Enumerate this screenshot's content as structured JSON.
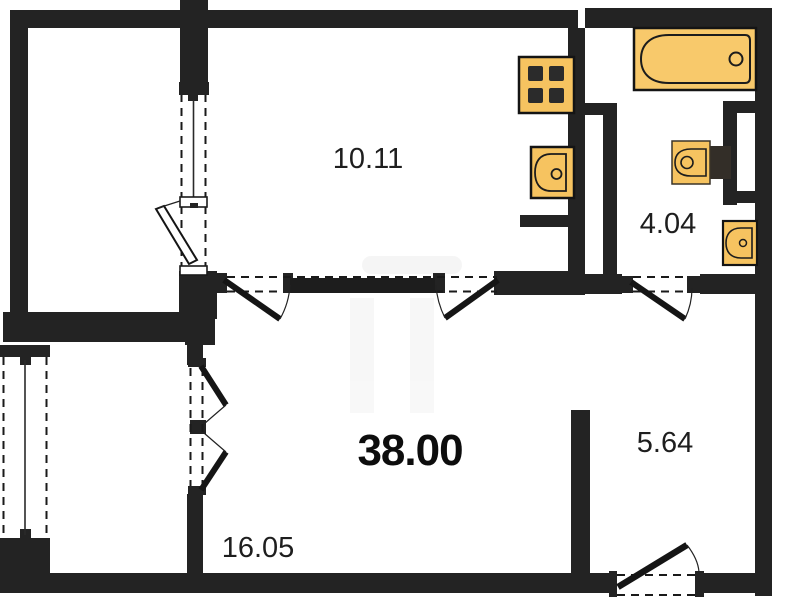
{
  "floorplan": {
    "type": "apartment-floor-plan",
    "total_area_label": "38.00",
    "rooms": [
      {
        "id": "kitchen",
        "area_label": "10.11"
      },
      {
        "id": "bathroom",
        "area_label": "4.04"
      },
      {
        "id": "hallway",
        "area_label": "5.64"
      },
      {
        "id": "living-room",
        "area_label": "16.05"
      }
    ],
    "fixtures": [
      "stove-icon",
      "kitchen-sink-icon",
      "bathtub-icon",
      "toilet-icon",
      "bathroom-sink-icon"
    ],
    "colors": {
      "wall": "#232323",
      "fixture_fill": "#f6c360",
      "bathtub_fill": "#f8c96b",
      "fixture_stroke": "#141414",
      "label": "#1e1e1e",
      "background": "#ffffff"
    }
  }
}
